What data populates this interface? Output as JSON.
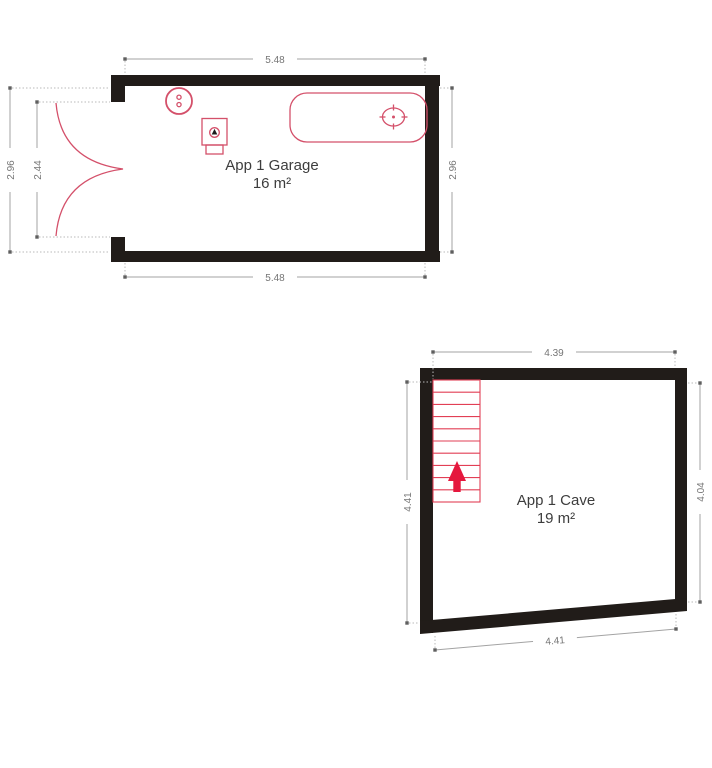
{
  "page": {
    "background_color": "#ffffff",
    "type_label": "floor-plan"
  },
  "plans": {
    "garage": {
      "title": "App 1 Garage",
      "area": "16 m²",
      "dimensions": {
        "top": "5.48",
        "bottom": "5.48",
        "left_outer": "2.96",
        "left_inner": "2.44",
        "right": "2.96"
      },
      "fixtures": [
        {
          "icon": "double-door-swing-icon"
        },
        {
          "icon": "boiler-icon"
        },
        {
          "icon": "heater-icon"
        },
        {
          "icon": "bathtub-icon"
        }
      ]
    },
    "cave": {
      "title": "App 1 Cave",
      "area": "19 m²",
      "dimensions": {
        "top": "4.39",
        "left": "4.41",
        "right": "4.04",
        "bottom": "4.41"
      },
      "fixtures": [
        {
          "icon": "staircase-icon"
        },
        {
          "icon": "up-arrow-icon"
        }
      ]
    }
  },
  "colors": {
    "wall": "#211c19",
    "fixture_red": "#d4506a",
    "stair_red": "#e23f55",
    "arrow_red": "#e5173d",
    "dimension_line": "#a3a3a3",
    "dimension_text": "#757575",
    "label_text": "#3d3d3d"
  }
}
